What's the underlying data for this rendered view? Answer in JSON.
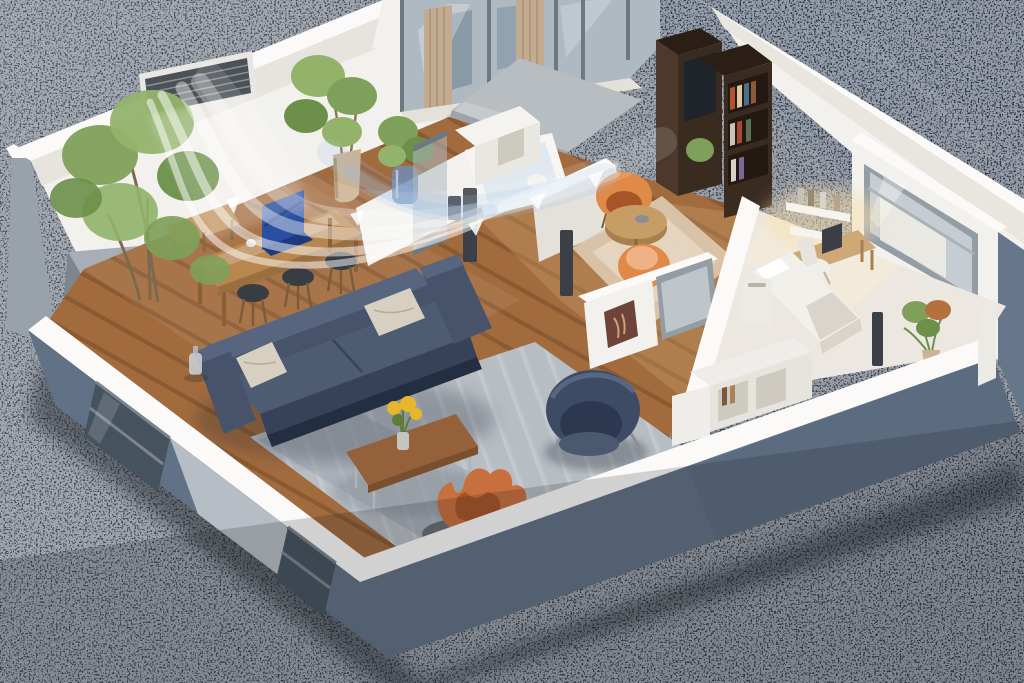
{
  "scene": {
    "type": "isometric-3d-cutaway-floorplan-render",
    "setting": "miniature apartment model with cut-away walls standing on a dark speckled stone surface",
    "visualization": "white airflow streams with arrows blowing from a wall air-conditioner vent across the dining and living area",
    "rooms": [
      "living-room",
      "dining-area",
      "bathroom",
      "hallway",
      "reading-nook",
      "bedroom-office",
      "balcony"
    ],
    "objects": [
      "tall-corner-tree",
      "gray-planter-box",
      "air-conditioner-vent",
      "airflow-streams",
      "dining-table",
      "blue-laptop",
      "dining-stools",
      "wooden-bench",
      "potted-ficus",
      "plant-in-blue-vase",
      "sliding-glass-doors",
      "beige-curtains",
      "balcony-slab",
      "bathtub",
      "bathroom-partitions",
      "toilet-roll-stand",
      "kitchen-cabinet",
      "dark-bookshelf",
      "orange-nook-chairs",
      "round-nook-table",
      "beige-nook-rug",
      "wall-art",
      "interior-window",
      "gray-sofa",
      "beige-pillows",
      "gray-area-rug",
      "coffee-table",
      "yellow-flower-vase",
      "orange-lounge-chair",
      "navy-armchair",
      "glass-water-jug",
      "bed",
      "air-purifier",
      "desk",
      "wall-shelves",
      "desk-chair",
      "bedroom-window",
      "corner-flower-plant",
      "white-cube-shelf",
      "glass-partition",
      "door-posts"
    ]
  },
  "palette": {
    "ground": "#3d4654",
    "groundLight": "#4d5665",
    "groundDark": "#2c3849",
    "wallWhite": "#f2f1ed",
    "wallCap": "#fbfaf8",
    "wallShade": "#e4e1db",
    "wallCut": "#617186",
    "wallCutDark": "#56657a",
    "leftWallGray": "#99a1aa",
    "planterGray": "#8d959d",
    "planterTop": "#a7aeb5",
    "floorWood": "#a26b3e",
    "floorWoodSeam": "#6e4524",
    "hallWood": "#c89a68",
    "bedroomFloor": "#ece8e1",
    "rug": "#b7bdc3",
    "rugLight": "#cdd1d5",
    "nookRug": "#dcc9b0",
    "sofa": "#46536a",
    "sofaDark": "#37425a",
    "sofaMid": "#4d5b73",
    "sofaLight": "#57667e",
    "pillow": "#d7d0c1",
    "coffeeTable": "#94613a",
    "coffeeTableDark": "#7a4f2c",
    "flowerYellow": "#e8b62a",
    "leafGreen": "#5f7d3a",
    "navyChair": "#3e4b64",
    "navyChairDark": "#2c3850",
    "navyChairLight": "#4a5870",
    "orangeChair": "#c8703d",
    "orangeChairDark": "#a85529",
    "nookChair": "#e08a4a",
    "diningTable": "#b8874f",
    "benchWood": "#c59a68",
    "stool": "#383d44",
    "stoolLeg": "#7c5a3a",
    "laptopBlue": "#2b4fa0",
    "laptopBlueDark": "#1d3a7e",
    "bookshelf": "#3a2b21",
    "bookshelfSide": "#4c392b",
    "bookshelfTop": "#2a1e16",
    "glass": "#aeb9c1",
    "glassDark": "#46525e",
    "glassFrame": "#6e7880",
    "curtain": "#c2ab90",
    "slab": "#b8bdc2",
    "slabLight": "#c7cacd",
    "vent": "#4b5157",
    "ventFrame": "#e8e7e4",
    "tub": "#f6f5f2",
    "water": "#dfe9ef",
    "treeGreen": "#7fa05a",
    "treeGreenDark": "#6c8f4a",
    "treeGreenLight": "#93b36b",
    "potBeige": "#cbb293",
    "vaseBlue": "#6f8fb8",
    "bedWhite": "#f2f0ea",
    "blanket": "#d9d5cc",
    "deskWood": "#cfa878",
    "shelfGlow": "#f5dfb0",
    "purifier": "#eceae5",
    "cubeShelf": "#efedea",
    "cubeInner": "#cfcabf",
    "post": "#3b4046",
    "artBrown": "#6e4438",
    "plantRust": "#b4703e",
    "windowGlass": "#c6cdd2",
    "windowFrame": "#949ca4",
    "outerRight": "#66778c",
    "decanter": "#cdd4d8",
    "airflow": "#ffffff",
    "airflowBlue": "#9fc0e8"
  }
}
